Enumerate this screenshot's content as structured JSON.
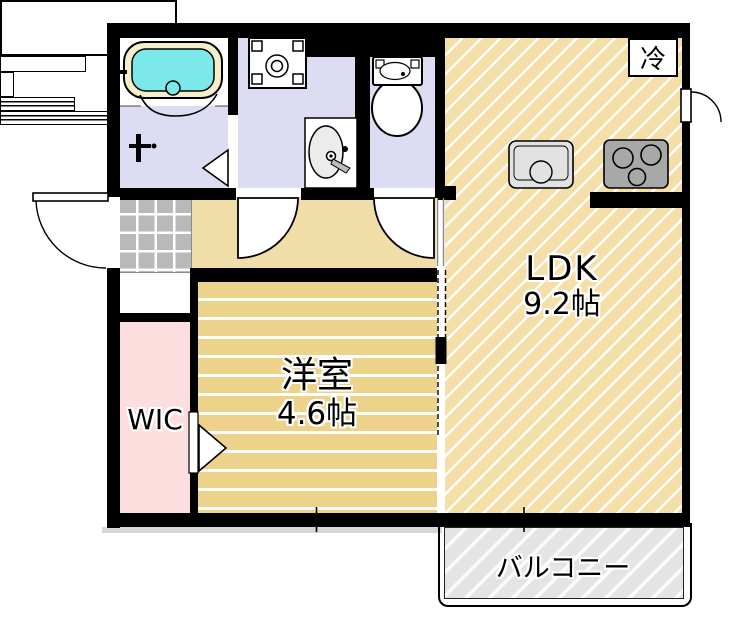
{
  "plan": {
    "title": "1LDK apartment floor plan",
    "rooms": {
      "ldk": {
        "name": "LDK",
        "area": "9.2帖"
      },
      "western_room": {
        "name": "洋室",
        "area": "4.6帖"
      },
      "wic": {
        "name": "WIC"
      },
      "balcony": {
        "name": "バルコニー"
      },
      "refrigerator": {
        "name": "冷"
      }
    },
    "colors": {
      "wall": "#000000",
      "ldk": "#f3dfa7",
      "western": "#edd28c",
      "hall": "#f1dda7",
      "wic": "#fcdede",
      "sanitary": "#dcdcf2",
      "entrance_tile": "#b9b9b9",
      "balcony": "#e4e4e4",
      "bathtub": "#7be9ea",
      "tub_rim": "#f4eecb",
      "sink": "#e2e2e2",
      "stove": "#a8a8a8",
      "text": "#000000"
    }
  }
}
